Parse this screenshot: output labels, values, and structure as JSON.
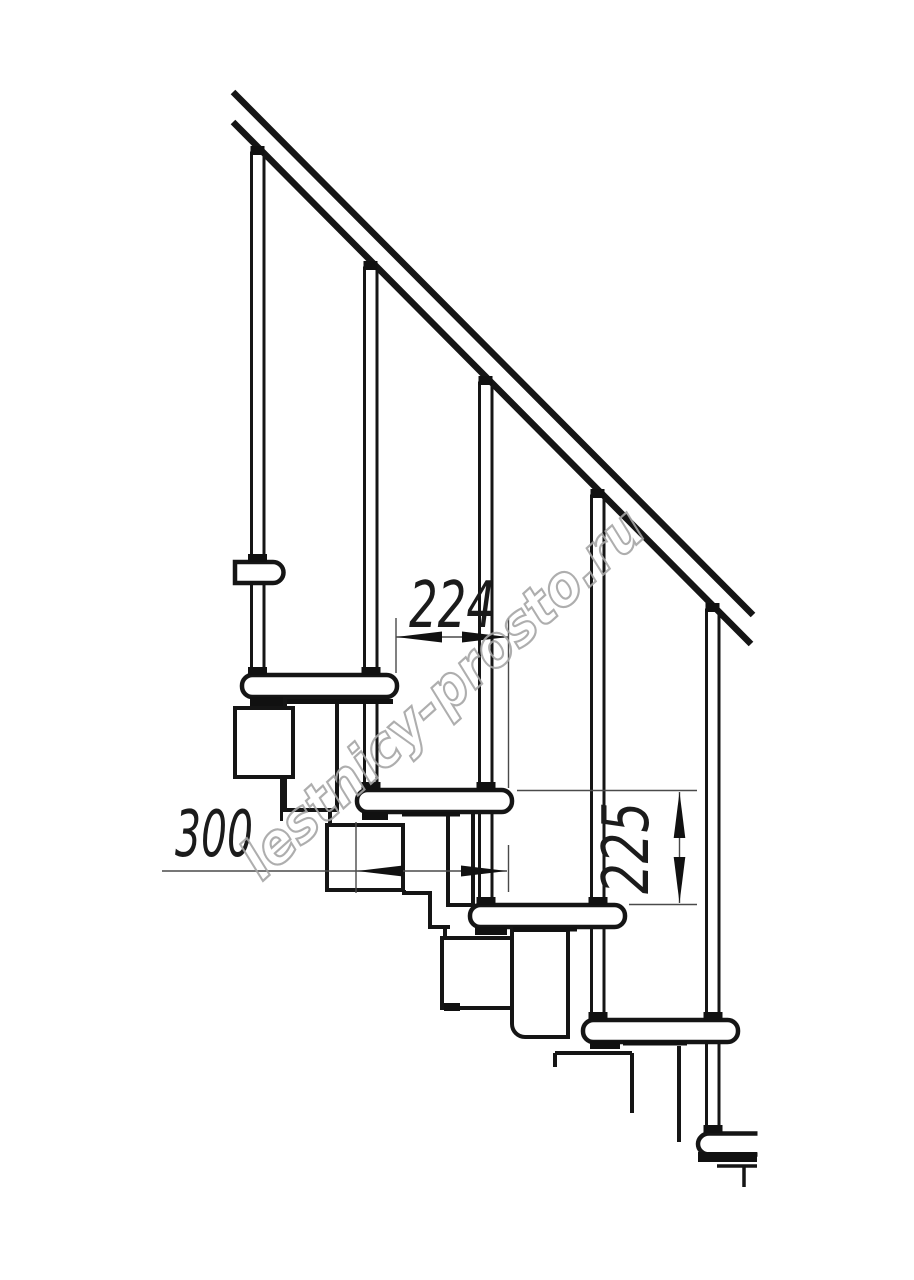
{
  "drawing": {
    "title": "Modular staircase side-view technical drawing",
    "watermark": "lestnicy-prosto.ru",
    "dimensions": {
      "step_run": "224",
      "tread_depth": "300",
      "step_rise": "225"
    },
    "counts": {
      "balusters": 5,
      "treads": 5
    }
  },
  "colors": {
    "line": "#151515",
    "dim_line": "#4a4a4a",
    "dim_text": "#1b1b1b",
    "watermark": "#a6a6a6",
    "background": "#ffffff"
  }
}
